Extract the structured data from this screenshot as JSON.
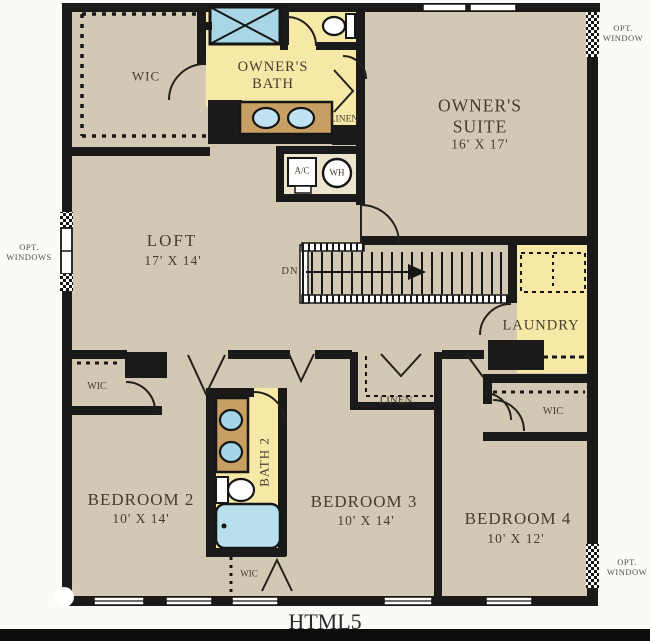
{
  "watermark": "HTML5",
  "colors": {
    "background": "#fafaf7",
    "floor": "#d3c8b4",
    "room_yellow": "#f6e8a6",
    "closet_cream": "#ece5cd",
    "fixture_blue": "#a9d6e7",
    "tub_blue": "#b7dfee",
    "vanity_tan": "#c79f63",
    "wall": "#1a1a1a",
    "label_text": "#463c30",
    "annotation_text": "#55504a",
    "footer_bar": "#0d0d0d"
  },
  "rooms": {
    "owners_suite": {
      "line1": "OWNER'S",
      "line2": "SUITE",
      "dims": "16' X 17'"
    },
    "owners_bath": {
      "line1": "OWNER'S",
      "line2": "BATH"
    },
    "loft": {
      "label": "LOFT",
      "dims": "17' X 14'"
    },
    "laundry": {
      "label": "LAUNDRY"
    },
    "bedroom2": {
      "label": "BEDROOM 2",
      "dims": "10' X 14'"
    },
    "bedroom3": {
      "label": "BEDROOM 3",
      "dims": "10' X 14'"
    },
    "bedroom4": {
      "label": "BEDROOM 4",
      "dims": "10' X 12'"
    },
    "bath2": {
      "label": "BATH 2"
    }
  },
  "closets": {
    "wic_owner": "WIC",
    "wic_bedroom2": "WIC",
    "wic_hall": "WIC",
    "wic_bedroom4": "WIC",
    "linen_owner": "LINEN",
    "linen_hall": "LINEN"
  },
  "fixtures": {
    "ac_unit": "A/C",
    "water_heater": "WH"
  },
  "annotations": {
    "stairs_direction": "DN",
    "opt_window_top": {
      "line1": "OPT.",
      "line2": "WINDOW"
    },
    "opt_windows_left": {
      "line1": "OPT.",
      "line2": "WINDOWS"
    },
    "opt_window_bottom": {
      "line1": "OPT.",
      "line2": "WINDOW"
    }
  }
}
